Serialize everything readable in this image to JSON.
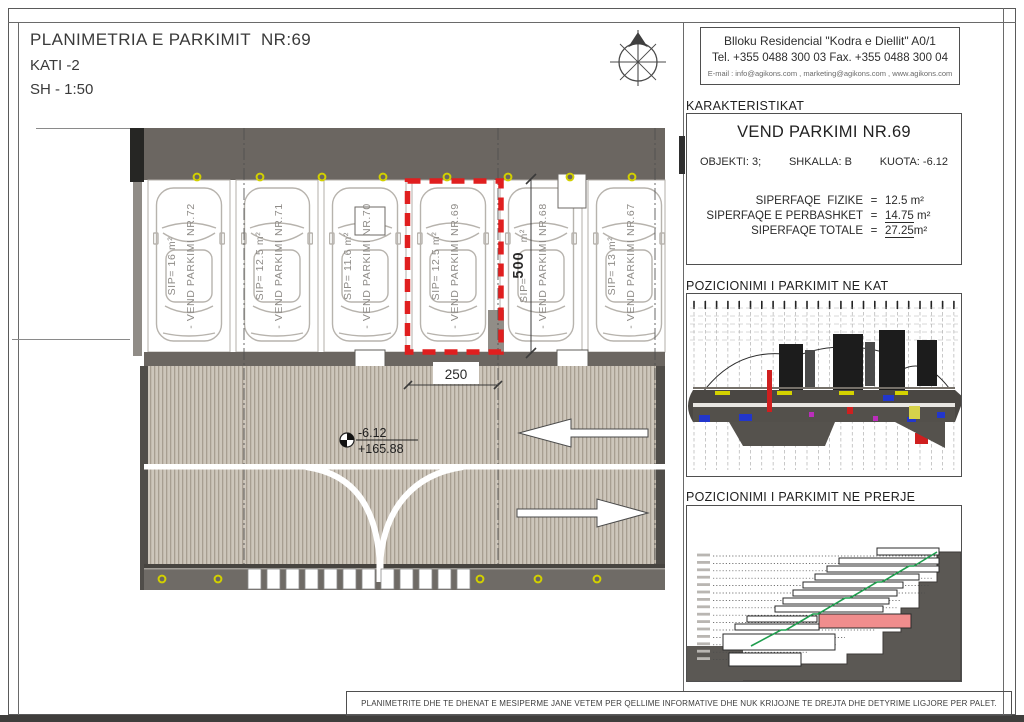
{
  "title_block": {
    "line1": "PLANIMETRIA E PARKIMIT  NR:69",
    "line2": "KATI -2",
    "line3": "SH - 1:50"
  },
  "contact_box": {
    "line1": "Blloku Residencial \"Kodra e Diellit\" A0/1",
    "line2": "Tel. +355 0488 300 03   Fax. +355 0488 300 04",
    "line3": "E-mail : info@agikons.com , marketing@agikons.com , www.agikons.com"
  },
  "characteristics": {
    "heading": "KARAKTERISTIKAT",
    "title": "VEND PARKIMI NR.69",
    "objekti": "OBJEKTI: 3;",
    "shkalla": "SHKALLA: B",
    "kuota": "KUOTA: -6.12",
    "areas": [
      {
        "label": "SIPERFAQE  FIZIKE",
        "eq": "=",
        "value": "12.5",
        "unit": "m²"
      },
      {
        "label": "SIPERFAQE E PERBASHKET",
        "eq": "=",
        "value": "14.75",
        "unit": "m²"
      },
      {
        "label": "SIPERFAQE TOTALE",
        "eq": "=",
        "value": "27.25",
        "unit": "m²"
      }
    ]
  },
  "panels": {
    "kat": "POZICIONIMI I PARKIMIT NE KAT",
    "prerje": "POZICIONIMI I PARKIMIT NE PRERJE"
  },
  "plan": {
    "spots": [
      {
        "sip": "SIP= 16 m²",
        "name": "- VEND PARKIMI NR.72"
      },
      {
        "sip": "SIP= 12.5 m²",
        "name": "- VEND PARKIMI NR.71"
      },
      {
        "sip": "SIP= 11.6 m²",
        "name": "- VEND PARKIMI NR.70"
      },
      {
        "sip": "SIP= 12.5 m²",
        "name": "- VEND PARKIMI NR.69"
      },
      {
        "sip": "SIP=          m²",
        "name": "- VEND PARKIMI NR.68"
      },
      {
        "sip": "SIP= 13 m²",
        "name": "- VEND PARKIMI NR.67"
      }
    ],
    "dim_width": "250",
    "dim_depth": "500",
    "level": {
      "relative": "-6.12",
      "absolute": "+165.88"
    }
  },
  "footer": {
    "disclaimer": "PLANIMETRITE DHE TE DHENAT E MESIPERME JANE VETEM PER QELLIME INFORMATIVE DHE NUK KRIJOJNE TE DREJTA DHE DETYRIME LIGJORE PER PALET."
  },
  "colors": {
    "highlight_red": "#e01f1f",
    "band_gray": "#6b6661",
    "hatch_base": "#cdc6bb",
    "light_yellow": "#d2d000"
  }
}
